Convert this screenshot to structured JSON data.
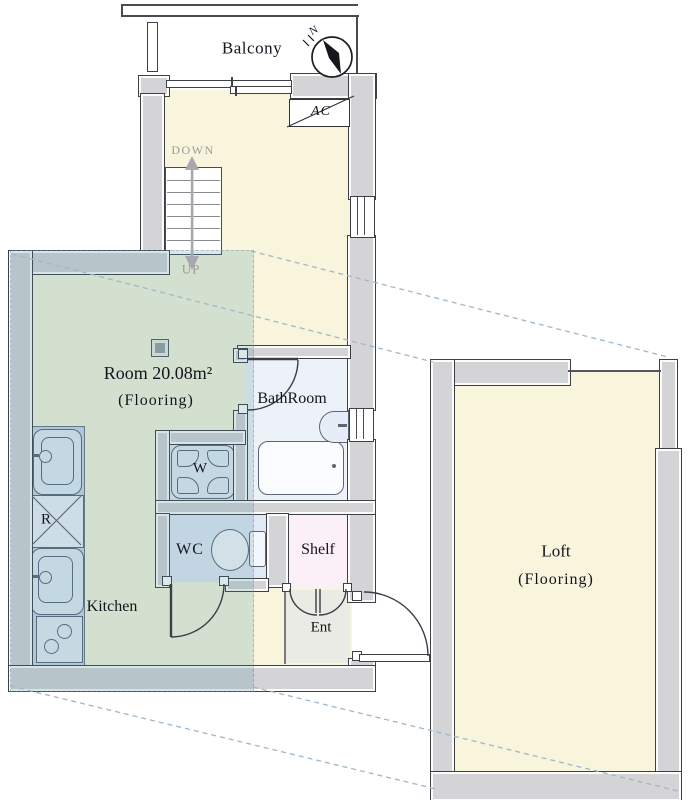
{
  "rooms": {
    "balcony": {
      "label": "Balcony"
    },
    "main_room": {
      "label": "Room 20.08m²",
      "sublabel": "(Flooring)"
    },
    "bathroom": {
      "label": "BathRoom"
    },
    "kitchen": {
      "label": "Kitchen"
    },
    "wc": {
      "label": "WC"
    },
    "shelf": {
      "label": "Shelf"
    },
    "entrance": {
      "label": "Ent"
    },
    "loft": {
      "label": "Loft",
      "sublabel": "(Flooring)"
    }
  },
  "fixtures": {
    "washer": {
      "label": "W"
    },
    "refrigerator": {
      "label": "R"
    },
    "air_conditioner": {
      "label": "AC"
    }
  },
  "stairs": {
    "down_label": "DOWN",
    "up_label": "UP"
  },
  "compass": {
    "north_label": "N"
  },
  "colors": {
    "wall_fill": "#d4d4d6",
    "wall_border": "#3f3f46",
    "floor_cream": "#f8f5dc",
    "bath_floor": "#edf2f8",
    "blue_floor": "#e0e9f4",
    "pink_floor": "#fbf0f7",
    "gray_floor": "#ebebe5",
    "counter": "#cbd6e8",
    "fixture_fill": "#e4ebf6",
    "fixture_border": "#5a6578",
    "overlay": "rgba(70,140,155,0.20)",
    "dash": "#9fb7c9",
    "text": "#14141e",
    "muted": "#9a9a9a"
  }
}
